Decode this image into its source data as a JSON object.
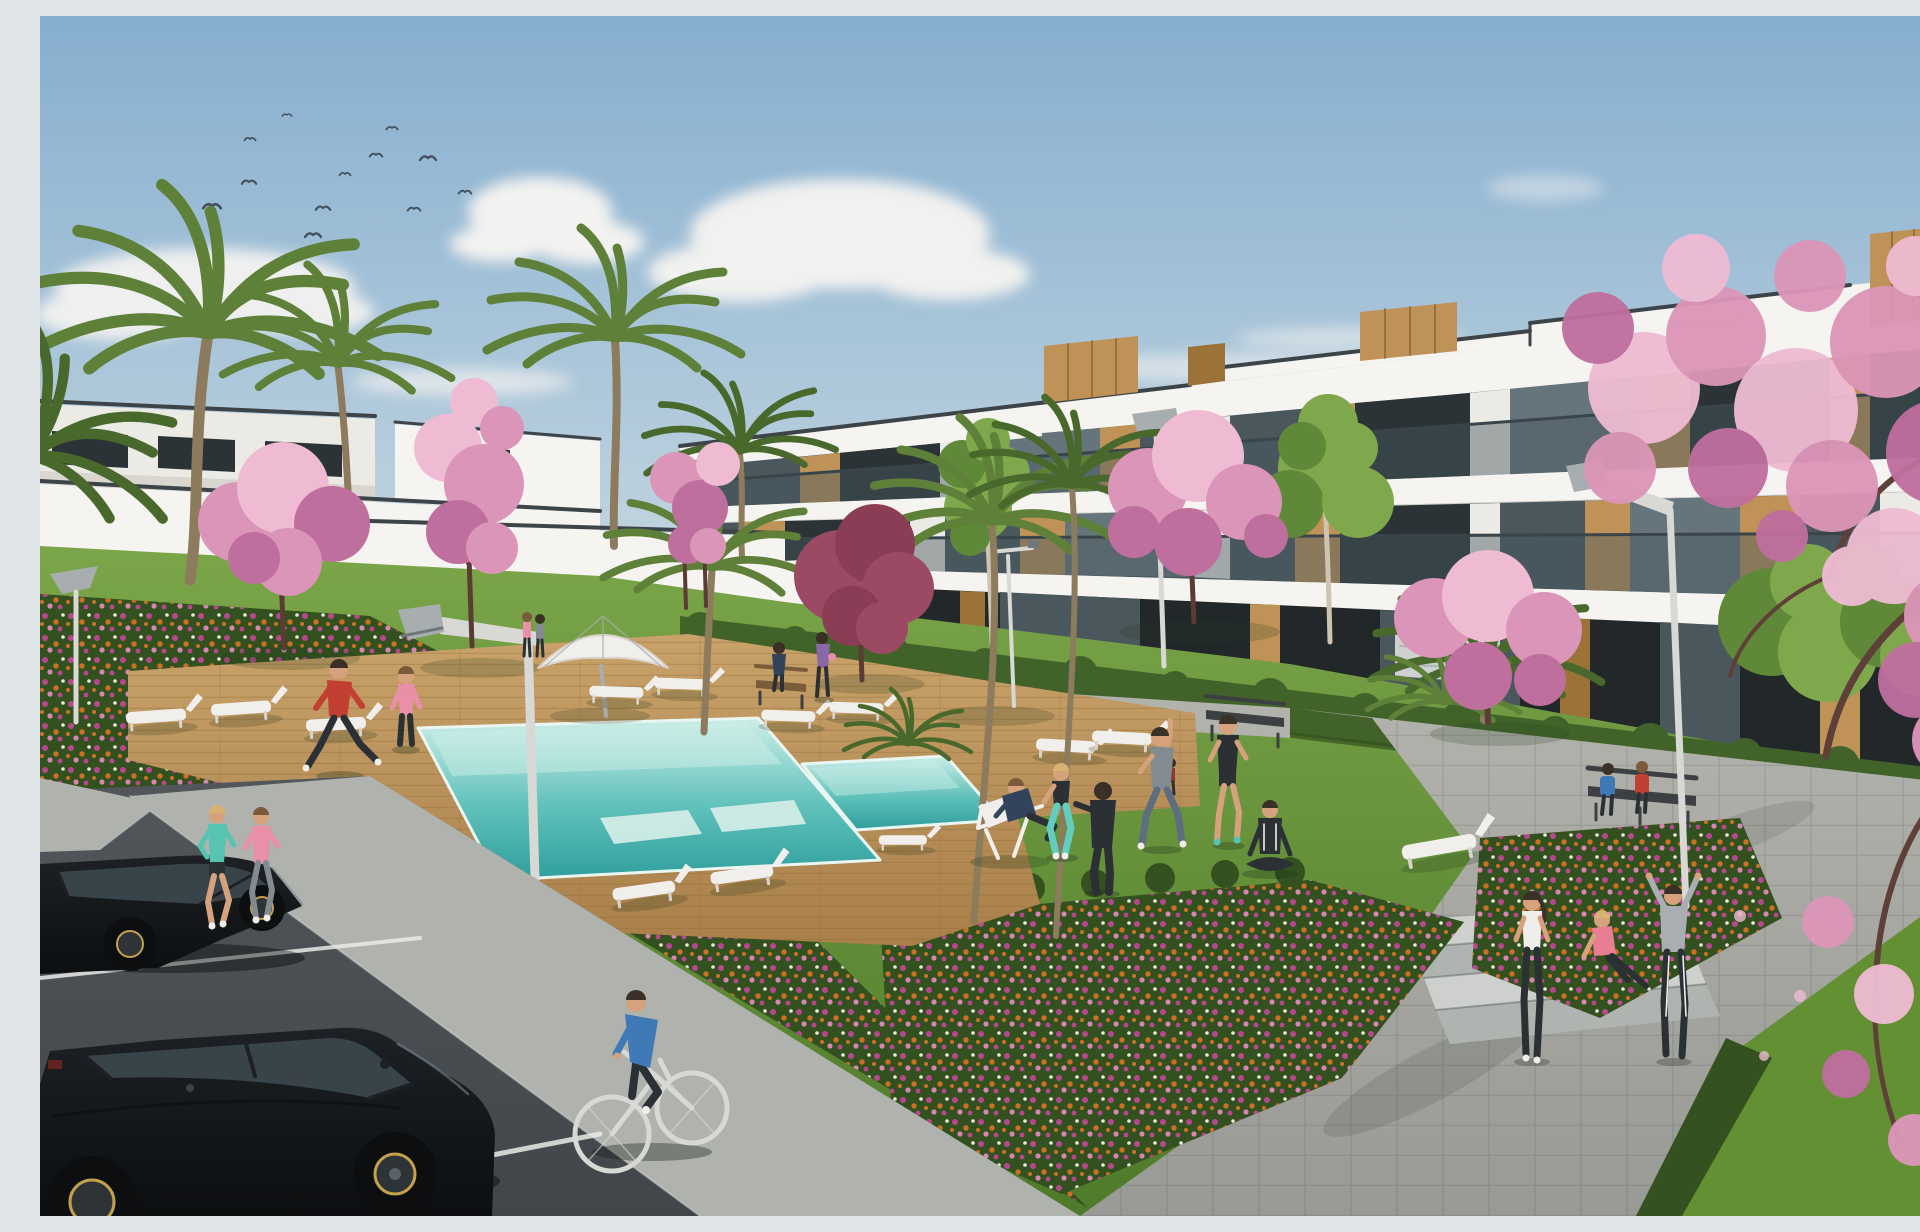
{
  "meta": {
    "type": "architectural-rendering",
    "description": "3D architect's render of a modern white apartment complex with wooden facade accents and glass balconies, landscaped gardens with cherry-blossom and palm trees, a turquoise swimming pool on a wooden deck with sun loungers and a parasol, residents jogging, cycling and exercising on the lawn, and a parking area with two black hatchbacks under a blue sky with a flock of birds."
  },
  "colors": {
    "sky-top": "#86aecf",
    "sky-mid": "#b7cedd",
    "sky-low": "#e3e7e4",
    "cloud": "#f6f4f1",
    "bird": "#44505c",
    "fac-lit": "#f6f4f0",
    "fac-white": "#eceae4",
    "fac-shade": "#d9d6cf",
    "fac-dark": "#c2beb5",
    "roof-cap": "#3d4449",
    "ground-dark": "#22272a",
    "interior-lit": "#cdd1d0",
    "glass-dark": "#2b3336",
    "glass-mid": "#4a575d",
    "glass-light": "#66757c",
    "wood": "#bf9257",
    "wood-dark": "#9b7338",
    "wood-line": "#7c5a2b",
    "rail": "rgba(72,88,94,0.45)",
    "rail-top": "#3a454b",
    "lawn-light": "#7ba548",
    "lawn": "#639033",
    "lawn-dark": "#4e7a2b",
    "hedge": "#41632a",
    "hedge-dark": "#34511f",
    "palm": "#5e8039",
    "palm-dark": "#49682b",
    "trunk": "#8d7b5d",
    "birch-trunk": "#cfc3b2",
    "pink-1": "#eebbd2",
    "pink-2": "#db95b8",
    "pink-3": "#bf6f9e",
    "maroon": "#9c4a63",
    "maroon-2": "#8b3d55",
    "branch": "#5e4038",
    "trunk-dark": "#5a3c34",
    "green-tree": "#7fa84d",
    "green-tree-2": "#5f8838",
    "water-1": "#cdeee8",
    "water-2": "#5fc1ba",
    "water-3": "#2f9e9c",
    "pool-edge": "#e9f6f2",
    "deck-1": "#c9a26a",
    "deck-2": "#a97f4a",
    "deck-line": "#8a6636",
    "path-1": "#b2b2ac",
    "path-2": "#999a95",
    "pave": "#b0b2ae",
    "asphalt": "#52575b",
    "asphalt-2": "#41464a",
    "line-white": "#e9eae8",
    "concrete": "#cdd0cd",
    "concrete-2": "#b0b4b1",
    "car": "#1d2125",
    "car-2": "#0c0e10",
    "car-glass": "#39434a",
    "car-rim": "#c4a14a",
    "car-hl": "#77838c",
    "taillight": "#6e2620",
    "lamp": "#d8d8d5",
    "lamp-2": "#a8adaf",
    "lamp-dark": "#70777b",
    "lounge": "#f1efeb",
    "lounge-2": "#d8d4cd",
    "bench-wood": "#7a5c39",
    "bench-dark": "#3c4043",
    "bed": "#33511f",
    "flo-magenta": "#b9478f",
    "flo-orange": "#cc7026",
    "flo-white": "#ece7dc",
    "flo-pink": "#d987b2",
    "skin": "#d6a27e",
    "hair-dark": "#3a3028",
    "hair-blond": "#d7b273",
    "hair-brown": "#7a5a3a",
    "red": "#c23f34",
    "teal": "#57c4b2",
    "pinkw": "#e98fa7",
    "blue": "#3f79b6",
    "navy": "#31445c",
    "gray-tee": "#848b90",
    "dark-cloth": "#2b3034",
    "jeans": "#5c6e80",
    "teal-leg": "#62cec0",
    "purple": "#8a68a8",
    "white-top": "#efeeea",
    "hoodie": "#a9aeb2",
    "pink-sit": "#e77e93",
    "red-kid": "#8e3a33"
  },
  "scene": {
    "sky": {
      "cloud_groups": 6,
      "birds": 12
    },
    "buildings": [
      {
        "id": "right-apartment-block",
        "floors": 3,
        "features": [
          "glass balconies",
          "wood panel accents",
          "rooftop wood boxes",
          "stepped roof parapet"
        ]
      },
      {
        "id": "far-left-building",
        "floors": 1
      },
      {
        "id": "left-wing",
        "floors": 2
      },
      {
        "id": "center-porch",
        "floors": 1
      },
      {
        "id": "arch-staircase"
      },
      {
        "id": "exterior-staircase"
      }
    ],
    "amenities": {
      "pools": [
        "main-pool",
        "kids-pool"
      ],
      "wooden_deck": true,
      "parasol": 1,
      "sun_loungers": 13,
      "deck_chair": 1,
      "benches": 3,
      "street_lamps": 6,
      "concrete_steps": 3
    },
    "landscape": {
      "palm_trees": 9,
      "blossom_trees": 7,
      "maroon_tree": 1,
      "green_trees": 3,
      "flower_beds": 3,
      "hedges": true,
      "lawn": true
    },
    "people": [
      {
        "id": "jogger-teal",
        "activity": "jogging"
      },
      {
        "id": "jogger-pink",
        "activity": "jogging"
      },
      {
        "id": "cyclist",
        "activity": "cycling"
      },
      {
        "id": "man-stretching-red",
        "activity": "stretching"
      },
      {
        "id": "woman-standing-pink",
        "activity": "standing"
      },
      {
        "id": "man-deck-chair",
        "activity": "lounging"
      },
      {
        "id": "woman-squat-teal-leggings",
        "activity": "exercising"
      },
      {
        "id": "person-tracksuit",
        "activity": "exercising"
      },
      {
        "id": "man-stretching-gray",
        "activity": "stretching"
      },
      {
        "id": "man-shorts",
        "activity": "exercising"
      },
      {
        "id": "woman-yoga",
        "activity": "seated yoga"
      },
      {
        "id": "woman-ponytail",
        "activity": "standing"
      },
      {
        "id": "woman-seated-pink",
        "activity": "sitting on steps"
      },
      {
        "id": "person-hoodie-arms-up",
        "activity": "stretching arms up"
      },
      {
        "id": "woman-walking-purple",
        "activity": "walking"
      },
      {
        "id": "person-on-bench",
        "activity": "sitting"
      },
      {
        "id": "child",
        "activity": "standing"
      },
      {
        "id": "bench-couple-blue",
        "activity": "sitting"
      },
      {
        "id": "bench-couple-red",
        "activity": "sitting"
      },
      {
        "id": "background-pair",
        "activity": "standing"
      }
    ],
    "vehicles": [
      {
        "id": "car-1",
        "type": "black hatchback"
      },
      {
        "id": "car-2",
        "type": "black hatchback"
      },
      {
        "id": "bicycle",
        "color": "white"
      }
    ]
  }
}
